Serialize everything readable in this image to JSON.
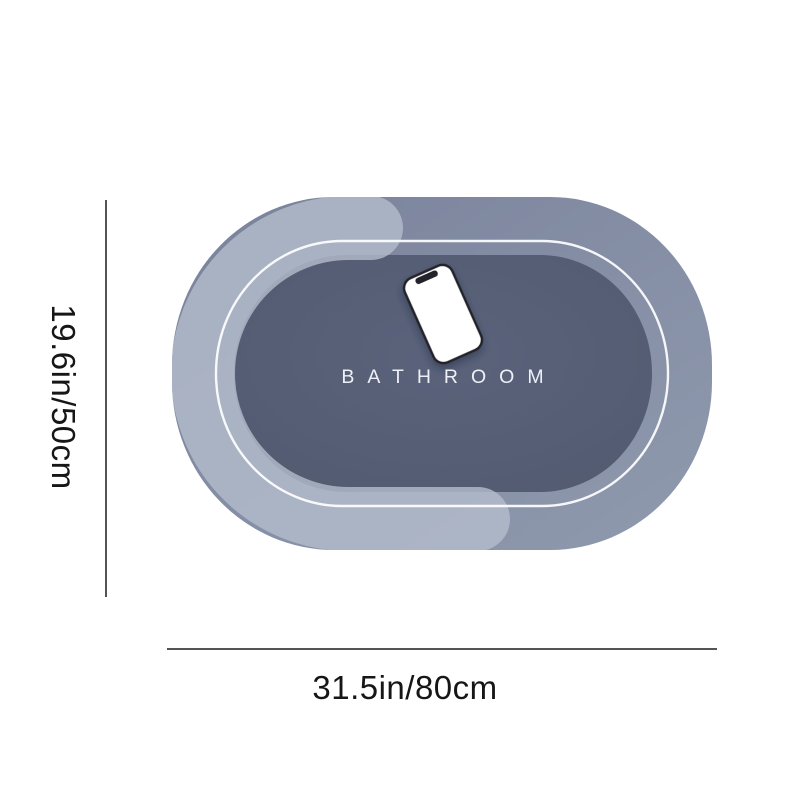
{
  "diagram": {
    "product": "bath-mat-size-diagram",
    "mat": {
      "brand_text": "BATHROOM",
      "graphic": "smartphone-icon"
    },
    "dimensions": {
      "height_label": "19.6in/50cm",
      "width_label": "31.5in/80cm"
    },
    "colors": {
      "background": "#ffffff",
      "mat-base": "#828ba3",
      "mat-base-dark": "#79829b",
      "mat-base-light": "#909aae",
      "mat-inner": "#525a70",
      "mat-inner-center": "#5b637c",
      "mat-accent": "#b4bdcc",
      "mat-outline": "#ffffff",
      "mat-text": "#edf0f6",
      "phone-body": "#ffffff",
      "phone-frame": "#22222b",
      "dimension-line": "#1c1c1c",
      "label-text": "#161616"
    }
  }
}
